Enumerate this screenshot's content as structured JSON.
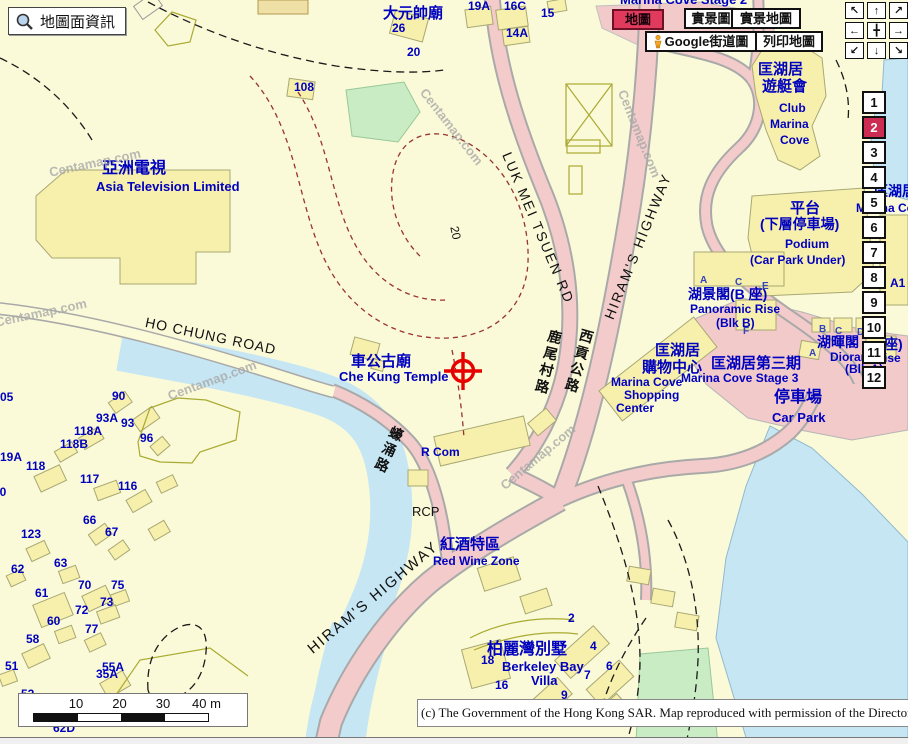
{
  "header": {
    "map_info_label": "地圖面資訊"
  },
  "toolbar": {
    "map": "地圖",
    "real_view": "實景圖",
    "real_map": "實景地圖",
    "google_street": "Google街道圖",
    "print": "列印地圖"
  },
  "nav_pad": {
    "arrows": [
      "↖",
      "↑",
      "↗",
      "←",
      "╋",
      "→",
      "↙",
      "↓",
      "↘"
    ]
  },
  "zoom_strip": {
    "levels": [
      "1",
      "2",
      "3",
      "4",
      "5",
      "6",
      "7",
      "8",
      "9",
      "10",
      "11",
      "12"
    ],
    "selected": "2"
  },
  "scale_bar": {
    "ticks": [
      "10",
      "20",
      "30",
      "40 m"
    ]
  },
  "copyright": "(c) The Government of the Hong Kong SAR. Map reproduced with permission of the Director of Lands",
  "colors": {
    "accent_red": "#E03A5C",
    "selected_zoom": "#CC2B52",
    "label_blue": "#0000BF",
    "water": "#C6E6F4",
    "road_pink": "#F3CBCB",
    "building": "#F7EFAC",
    "contour": "#993333",
    "green": "#C9ECC4"
  },
  "map": {
    "labels": [
      {
        "t": "大元帥廟",
        "x": 383,
        "y": 6,
        "cls": "zh",
        "s": 15,
        "n": "label-tai-yuen-shuai-temple"
      },
      {
        "t": "26",
        "x": 392,
        "y": 22,
        "cls": "num"
      },
      {
        "t": "20",
        "x": 407,
        "y": 46,
        "cls": "num"
      },
      {
        "t": "19A",
        "x": 468,
        "y": 0,
        "cls": "num"
      },
      {
        "t": "16C",
        "x": 504,
        "y": 0,
        "cls": "num"
      },
      {
        "t": "14A",
        "x": 506,
        "y": 27,
        "cls": "num"
      },
      {
        "t": "15",
        "x": 541,
        "y": 7,
        "cls": "num"
      },
      {
        "t": "108",
        "x": 294,
        "y": 81,
        "cls": "num"
      },
      {
        "t": "Marina Cove Stage 2",
        "x": 620,
        "y": -7,
        "cls": "en",
        "s": 13,
        "n": "label-marina-cove-stage2"
      },
      {
        "t": "亞洲電視",
        "x": 102,
        "y": 161,
        "cls": "zh",
        "s": 16,
        "n": "label-atv-zh"
      },
      {
        "t": "Asia Television Limited",
        "x": 96,
        "y": 180,
        "cls": "en",
        "s": 13,
        "n": "label-atv-en"
      },
      {
        "t": "匡湖居",
        "x": 758,
        "y": 62,
        "cls": "zh",
        "s": 15,
        "n": "label-club-marina-cove-zh1"
      },
      {
        "t": "遊艇會",
        "x": 762,
        "y": 79,
        "cls": "zh",
        "s": 15,
        "n": "label-club-marina-cove-zh2"
      },
      {
        "t": "Club",
        "x": 779,
        "y": 102,
        "cls": "en"
      },
      {
        "t": "Marina",
        "x": 770,
        "y": 118,
        "cls": "en"
      },
      {
        "t": "Cove",
        "x": 780,
        "y": 134,
        "cls": "en"
      },
      {
        "t": "平台",
        "x": 790,
        "y": 201,
        "cls": "zh",
        "s": 15,
        "n": "label-podium-zh"
      },
      {
        "t": "(下層停車場)",
        "x": 760,
        "y": 217,
        "cls": "zh",
        "s": 14
      },
      {
        "t": "Podium",
        "x": 785,
        "y": 238,
        "cls": "en",
        "n": "label-podium-en"
      },
      {
        "t": "(Car Park Under)",
        "x": 750,
        "y": 254,
        "cls": "en"
      },
      {
        "t": "匡湖居",
        "x": 874,
        "y": 184,
        "cls": "zh",
        "s": 14
      },
      {
        "t": "Marina Co",
        "x": 856,
        "y": 202,
        "cls": "en"
      },
      {
        "t": "湖景閣(B 座)",
        "x": 688,
        "y": 287,
        "cls": "zh",
        "s": 14,
        "n": "label-panoramic-rise-zh"
      },
      {
        "t": "Panoramic Rise",
        "x": 690,
        "y": 303,
        "cls": "en"
      },
      {
        "t": "(Blk B)",
        "x": 716,
        "y": 317,
        "cls": "en"
      },
      {
        "t": "湖暉閣",
        "x": 817,
        "y": 335,
        "cls": "zh",
        "s": 14
      },
      {
        "t": "座)",
        "x": 884,
        "y": 337,
        "cls": "zh",
        "s": 14
      },
      {
        "t": "Dioram",
        "x": 830,
        "y": 351,
        "cls": "en"
      },
      {
        "t": "ise",
        "x": 884,
        "y": 352,
        "cls": "en"
      },
      {
        "t": "(Blk A)",
        "x": 845,
        "y": 363,
        "cls": "en"
      },
      {
        "t": "匡湖居第三期",
        "x": 711,
        "y": 356,
        "cls": "zh",
        "s": 15,
        "n": "label-marina-cove-stage3-zh"
      },
      {
        "t": "Marina Cove Stage 3",
        "x": 681,
        "y": 372,
        "cls": "en"
      },
      {
        "t": "匡湖居",
        "x": 655,
        "y": 343,
        "cls": "zh",
        "s": 15,
        "n": "label-shopping-center-zh1"
      },
      {
        "t": "購物中心",
        "x": 642,
        "y": 360,
        "cls": "zh",
        "s": 15,
        "n": "label-shopping-center-zh2"
      },
      {
        "t": "Marina Cove",
        "x": 611,
        "y": 376,
        "cls": "en"
      },
      {
        "t": "Shopping",
        "x": 624,
        "y": 389,
        "cls": "en"
      },
      {
        "t": "Center",
        "x": 616,
        "y": 402,
        "cls": "en"
      },
      {
        "t": "停車場",
        "x": 774,
        "y": 390,
        "cls": "zh",
        "s": 16,
        "n": "label-car-park-zh"
      },
      {
        "t": "Car Park",
        "x": 772,
        "y": 411,
        "cls": "en",
        "s": 13,
        "n": "label-car-park-en"
      },
      {
        "t": "A1",
        "x": 890,
        "y": 277,
        "cls": "num"
      },
      {
        "t": "車公古廟",
        "x": 351,
        "y": 354,
        "cls": "zh",
        "s": 15,
        "n": "label-che-kung-temple-zh"
      },
      {
        "t": "Che Kung Temple",
        "x": 339,
        "y": 370,
        "cls": "en",
        "s": 13,
        "n": "label-che-kung-temple-en"
      },
      {
        "t": "R Com",
        "x": 421,
        "y": 446,
        "cls": "en"
      },
      {
        "t": "RCP",
        "x": 412,
        "y": 505,
        "cls": "blk",
        "s": 13
      },
      {
        "t": "紅酒特區",
        "x": 440,
        "y": 537,
        "cls": "zh",
        "s": 15,
        "n": "label-red-wine-zone-zh"
      },
      {
        "t": "Red Wine Zone",
        "x": 433,
        "y": 555,
        "cls": "en",
        "n": "label-red-wine-zone-en"
      },
      {
        "t": "柏麗灣別墅",
        "x": 487,
        "y": 642,
        "cls": "zh",
        "s": 16,
        "n": "label-berkeley-bay-zh"
      },
      {
        "t": "Berkeley Bay",
        "x": 502,
        "y": 660,
        "cls": "en",
        "s": 13
      },
      {
        "t": "Villa",
        "x": 531,
        "y": 674,
        "cls": "en",
        "s": 13
      },
      {
        "t": "HO CHUNG ROAD",
        "x": 147,
        "y": 315,
        "cls": "road",
        "r": 12,
        "ls": 1,
        "n": "label-ho-chung-road"
      },
      {
        "t": "LUK MEI TSUEN RD",
        "x": 513,
        "y": 150,
        "cls": "road",
        "r": 67,
        "ls": 2,
        "n": "label-luk-mei-tsuen-rd"
      },
      {
        "t": "HIRAM'S HIGHWAY",
        "x": 602,
        "y": 316,
        "cls": "road",
        "r": -68,
        "ls": 2,
        "n": "label-hirams-highway-north"
      },
      {
        "t": "HIRAM'S HIGHWAY",
        "x": 305,
        "y": 645,
        "cls": "road",
        "r": -40,
        "ls": 2,
        "s": 15,
        "n": "label-hirams-highway-south"
      },
      {
        "t": "鹿尾村路",
        "x": 549,
        "y": 328,
        "cls": "zhroad",
        "r": 14,
        "v": 1,
        "n": "label-luk-mei-tsuen-rd-zh"
      },
      {
        "t": "西貢公路",
        "x": 581,
        "y": 327,
        "cls": "zhroad",
        "r": 16,
        "v": 1,
        "n": "label-sai-kung-road-zh"
      },
      {
        "t": "蠔涌路",
        "x": 392,
        "y": 424,
        "cls": "zhroad",
        "r": 24,
        "v": 1,
        "n": "label-ho-chung-road-zh"
      },
      {
        "t": "20",
        "x": 460,
        "y": 225,
        "cls": "blk",
        "r": 78,
        "s": 12,
        "n": "label-contour-20"
      },
      {
        "t": "Centamap.com",
        "x": 48,
        "y": 166,
        "cls": "wm",
        "r": -12,
        "n": "watermark"
      },
      {
        "t": "Centamap.com",
        "x": 428,
        "y": 86,
        "cls": "wm",
        "r": 52,
        "n": "watermark"
      },
      {
        "t": "Centamap.com",
        "x": 628,
        "y": 88,
        "cls": "wm",
        "r": 68,
        "n": "watermark"
      },
      {
        "t": "Centamap.com",
        "x": 166,
        "y": 390,
        "cls": "wm",
        "r": -20,
        "n": "watermark"
      },
      {
        "t": "Centamap.com",
        "x": 498,
        "y": 482,
        "cls": "wm",
        "r": -40,
        "n": "watermark"
      },
      {
        "t": "Centamap.com",
        "x": -6,
        "y": 316,
        "cls": "wm",
        "r": -12,
        "n": "watermark"
      },
      {
        "t": "A",
        "x": 700,
        "y": 276,
        "cls": "blt"
      },
      {
        "t": "C",
        "x": 735,
        "y": 278,
        "cls": "blt"
      },
      {
        "t": "E",
        "x": 762,
        "y": 282,
        "cls": "blt"
      },
      {
        "t": "F",
        "x": 743,
        "y": 327,
        "cls": "blt"
      },
      {
        "t": "B",
        "x": 819,
        "y": 325,
        "cls": "blt"
      },
      {
        "t": "C",
        "x": 835,
        "y": 327,
        "cls": "blt"
      },
      {
        "t": "D",
        "x": 857,
        "y": 328,
        "cls": "blt"
      },
      {
        "t": "A",
        "x": 809,
        "y": 349,
        "cls": "blt"
      },
      {
        "t": "05",
        "x": 0,
        "y": 391,
        "cls": "num"
      },
      {
        "t": "90",
        "x": 112,
        "y": 390,
        "cls": "num"
      },
      {
        "t": "93A",
        "x": 96,
        "y": 412,
        "cls": "num"
      },
      {
        "t": "93",
        "x": 121,
        "y": 417,
        "cls": "num"
      },
      {
        "t": "118A",
        "x": 74,
        "y": 425,
        "cls": "num"
      },
      {
        "t": "118B",
        "x": 60,
        "y": 438,
        "cls": "num"
      },
      {
        "t": "96",
        "x": 140,
        "y": 432,
        "cls": "num"
      },
      {
        "t": "19A",
        "x": 0,
        "y": 451,
        "cls": "num"
      },
      {
        "t": "118",
        "x": 26,
        "y": 460,
        "cls": "num"
      },
      {
        "t": "117",
        "x": 80,
        "y": 473,
        "cls": "num"
      },
      {
        "t": "116",
        "x": 118,
        "y": 480,
        "cls": "num"
      },
      {
        "t": "20",
        "x": -7,
        "y": 486,
        "cls": "num"
      },
      {
        "t": "66",
        "x": 83,
        "y": 514,
        "cls": "num"
      },
      {
        "t": "67",
        "x": 105,
        "y": 526,
        "cls": "num"
      },
      {
        "t": "123",
        "x": 21,
        "y": 528,
        "cls": "num"
      },
      {
        "t": "62",
        "x": 11,
        "y": 563,
        "cls": "num"
      },
      {
        "t": "63",
        "x": 54,
        "y": 557,
        "cls": "num"
      },
      {
        "t": "61",
        "x": 35,
        "y": 587,
        "cls": "num"
      },
      {
        "t": "70",
        "x": 78,
        "y": 579,
        "cls": "num"
      },
      {
        "t": "75",
        "x": 111,
        "y": 579,
        "cls": "num"
      },
      {
        "t": "73",
        "x": 100,
        "y": 596,
        "cls": "num"
      },
      {
        "t": "72",
        "x": 75,
        "y": 604,
        "cls": "num"
      },
      {
        "t": "60",
        "x": 47,
        "y": 615,
        "cls": "num"
      },
      {
        "t": "77",
        "x": 85,
        "y": 623,
        "cls": "num"
      },
      {
        "t": "58",
        "x": 26,
        "y": 633,
        "cls": "num"
      },
      {
        "t": "51",
        "x": 5,
        "y": 660,
        "cls": "num"
      },
      {
        "t": "55A",
        "x": 102,
        "y": 661,
        "cls": "num"
      },
      {
        "t": "35A",
        "x": 96,
        "y": 668,
        "cls": "num"
      },
      {
        "t": "52",
        "x": 21,
        "y": 688,
        "cls": "num"
      },
      {
        "t": "62D",
        "x": 53,
        "y": 722,
        "cls": "num"
      },
      {
        "t": "2",
        "x": 568,
        "y": 612,
        "cls": "num"
      },
      {
        "t": "4",
        "x": 590,
        "y": 640,
        "cls": "num"
      },
      {
        "t": "6",
        "x": 606,
        "y": 660,
        "cls": "num"
      },
      {
        "t": "7",
        "x": 584,
        "y": 669,
        "cls": "num"
      },
      {
        "t": "9",
        "x": 561,
        "y": 689,
        "cls": "num"
      },
      {
        "t": "16",
        "x": 495,
        "y": 679,
        "cls": "num"
      },
      {
        "t": "18",
        "x": 481,
        "y": 654,
        "cls": "num"
      }
    ]
  }
}
